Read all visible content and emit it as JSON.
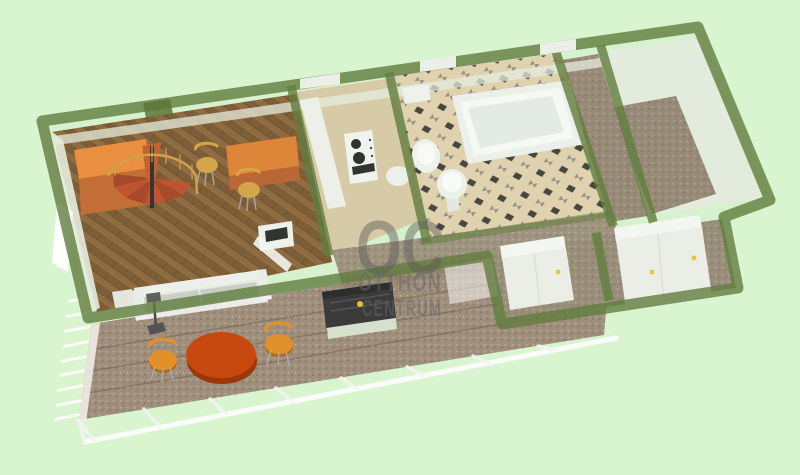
{
  "watermark": {
    "logo": "OC",
    "line1": "OTTHON",
    "line2": "CENTRUM"
  },
  "scene": {
    "type": "3d-floorplan-render",
    "description": "Bird's-eye 3D floor plan of an elongated apartment with terrace, spiral staircase and furniture",
    "background_color": "#d8f5cf",
    "wall_color": "#627d3e",
    "glass_tint": "#cfe2c4",
    "watermark_color": "#5a5a5a"
  },
  "palette": {
    "parquet": "#7a4f22",
    "kitchen_floor": "#d9c6a0",
    "bath_tile_base": "#e4cfab",
    "bath_tile_dark": "#2d2a26",
    "bath_tile_gray": "#8a8276",
    "hall_floor": "#958672",
    "terrace_floor": "#a08f7c",
    "room_floor": "#8d7a68",
    "furniture_orange": "#ef8026",
    "furniture_orange_dark": "#c2571c",
    "stair_step_red": "#bf3a14",
    "table_orange": "#c8490f",
    "chair_orange": "#e2902a",
    "white_fixture": "#f3f5f2",
    "sofa_gray": "#c9ccc8",
    "media_unit_dark": "#3b3b3b",
    "knob_yellow": "#e6c22b",
    "railing_white": "#fbfbf9"
  },
  "rooms": [
    {
      "name": "living-room",
      "floor": "herringbone-parquet"
    },
    {
      "name": "kitchen",
      "floor": "beige"
    },
    {
      "name": "bathroom",
      "floor": "checkered-tile"
    },
    {
      "name": "hallway",
      "floor": "brown-tile"
    },
    {
      "name": "bedroom",
      "floor": "brown-tile"
    },
    {
      "name": "storage-rooms",
      "floor": "brown-tile"
    },
    {
      "name": "terrace",
      "floor": "stone-slabs"
    }
  ],
  "furniture": [
    "orange-wardrobe",
    "spiral-staircase",
    "orange-desk",
    "dining-chairs",
    "sofa",
    "side-table",
    "floor-lamp",
    "media-unit",
    "open-door",
    "kitchen-counter",
    "stove",
    "bathtub",
    "toilet",
    "sink",
    "washbasin",
    "white-wardrobes",
    "round-terrace-table",
    "terrace-chairs",
    "terrace-railing"
  ]
}
